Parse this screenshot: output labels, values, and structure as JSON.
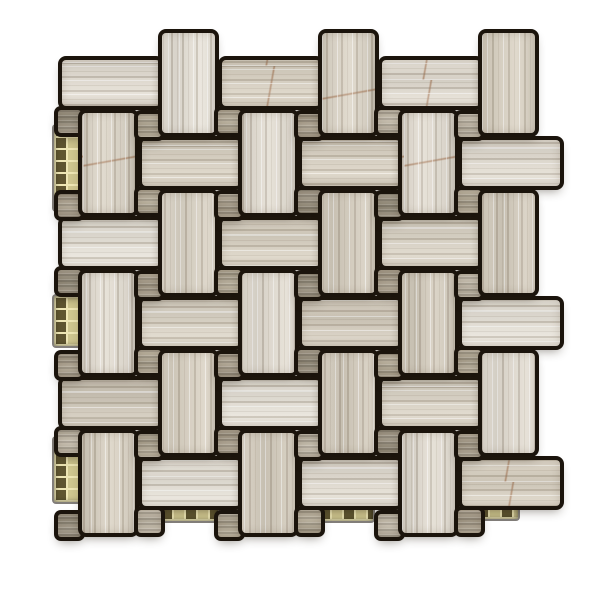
{
  "image": {
    "kind": "product-photo",
    "description": "Top-down product photo of a square mesh-mounted stone mosaic tile sheet in a basketweave pinwheel pattern. Light wood-grain beige-gray limestone rectangles alternate horizontal and vertical around small darker taupe square dot tiles, separated by dark near-black grout. The sheet edges are irregular and interlocking, with tiles protruding at the top, right and bottom. Strips of gold-green glass mosaic backing peek out along the left edge and in recesses along the bottom edge. Plain white background.",
    "background_color": "#ffffff"
  },
  "mosaic": {
    "pattern_type": "basketweave pinwheel with dot accents",
    "stage": {
      "width": 600,
      "height": 600
    },
    "lattice": {
      "origin_x": 242,
      "origin_y": 113,
      "step": 80,
      "i_min": -3,
      "i_max": 4,
      "j_min": -3,
      "j_max": 6,
      "parity": "even"
    },
    "pieces": {
      "vertical": {
        "dx": 0,
        "dy": 0,
        "w": 53,
        "h": 100,
        "grain": "vertical"
      },
      "horizontal": {
        "dx": 60,
        "dy": 27,
        "w": 98,
        "h": 46,
        "grain": "horizontal"
      },
      "dot_top": {
        "dx": 56,
        "dy": 1,
        "w": 23,
        "h": 23,
        "grain": "horizontal"
      },
      "dot_bottom": {
        "dx": 56,
        "dy": 77,
        "w": 23,
        "h": 23,
        "grain": "horizontal"
      }
    },
    "keep_bounds": {
      "x_min": 52,
      "x_max": 548,
      "y_min": 50,
      "y_max": 530
    },
    "colors": {
      "grout": "#1b140c",
      "stone_bases": [
        "#e3ddd2",
        "#dcd5c7",
        "#d5cdbe",
        "#e7e2d8",
        "#cfc7b8",
        "#dad2c3"
      ],
      "stone_vein_light": "rgba(255,255,255,0.50)",
      "stone_vein_dark": "rgba(128,114,94,0.30)",
      "stone_vein_faint": "rgba(128,114,94,0.14)",
      "rust_vein": "rgba(148,88,47,0.55)",
      "dot_bases": [
        "#b2a894",
        "#a99e8b",
        "#bfb6a5",
        "#99907e"
      ],
      "glass_base": "#8d8151",
      "glass_grout": "#eee6b4",
      "glass_dark": "#5f5530",
      "glass_light": "#cfc68f"
    },
    "glass_patches": [
      {
        "x": 54,
        "y": 126,
        "w": 30,
        "h": 84
      },
      {
        "x": 54,
        "y": 296,
        "w": 30,
        "h": 50
      },
      {
        "x": 54,
        "y": 438,
        "w": 34,
        "h": 64
      },
      {
        "x": 160,
        "y": 499,
        "w": 58,
        "h": 22
      },
      {
        "x": 318,
        "y": 499,
        "w": 55,
        "h": 22
      },
      {
        "x": 476,
        "y": 499,
        "w": 42,
        "h": 20
      }
    ]
  }
}
